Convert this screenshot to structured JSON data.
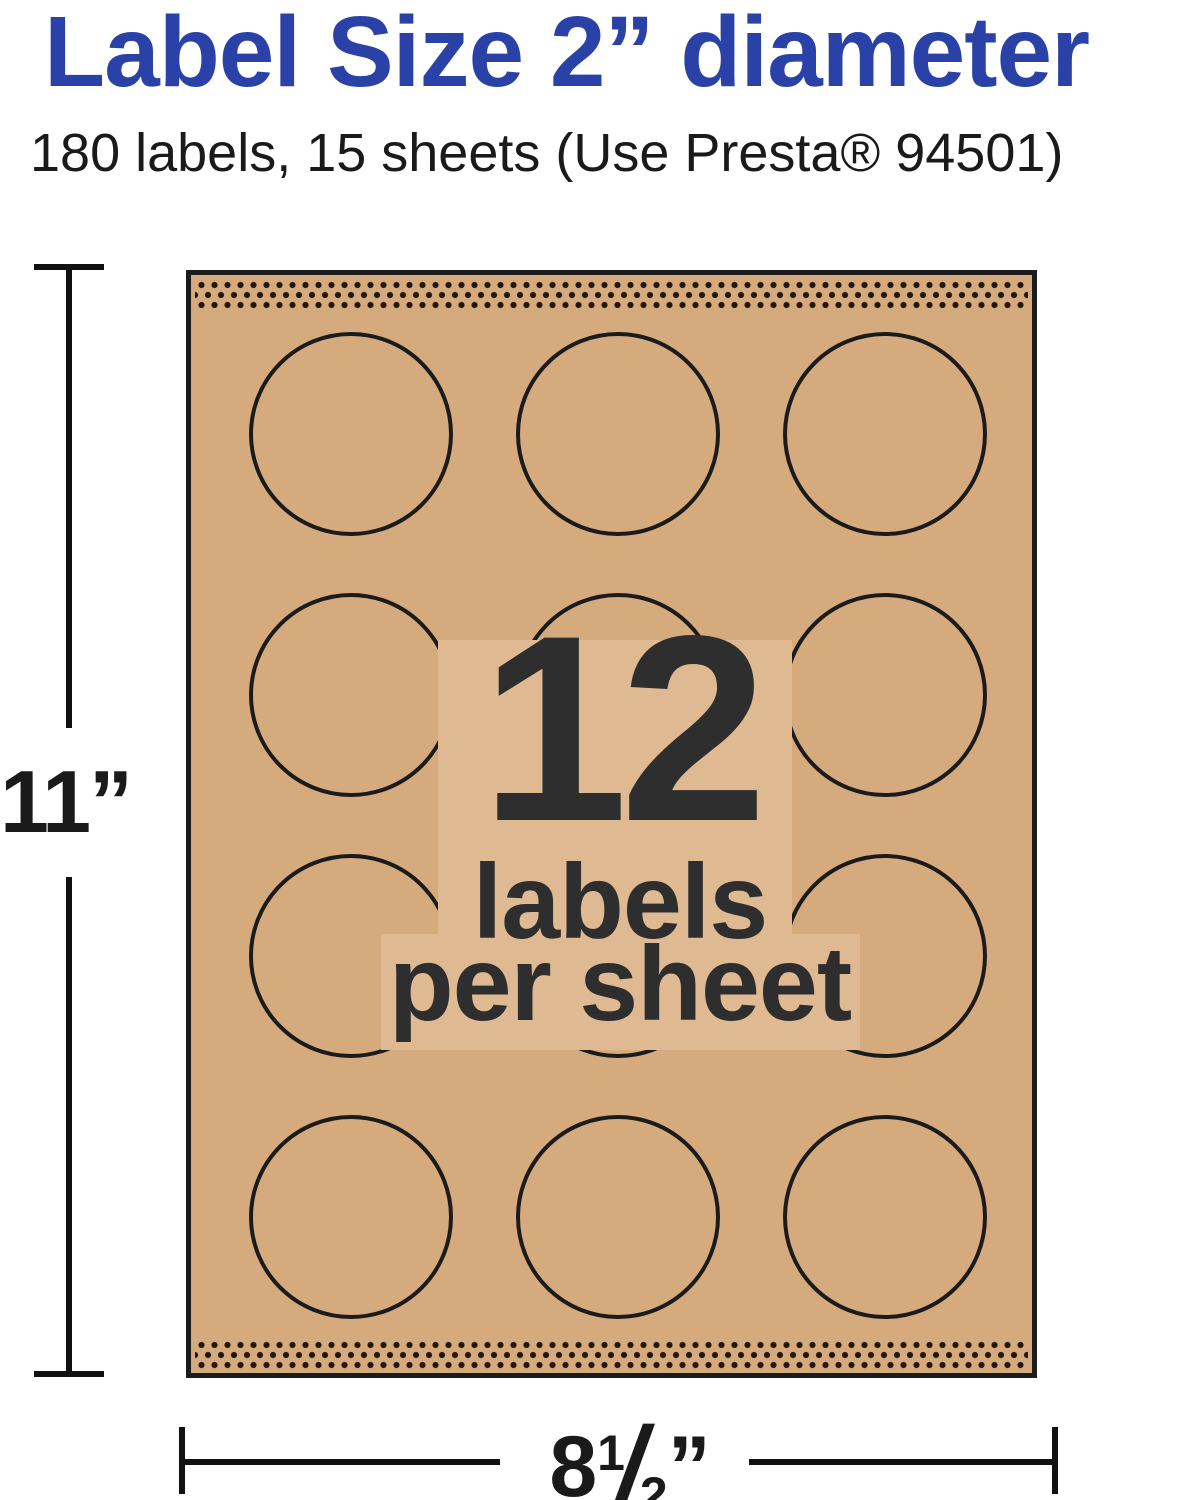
{
  "header": {
    "title": "Label Size 2” diameter",
    "subtitle": "180 labels, 15 sheets (Use Presta® 94501)"
  },
  "sheet": {
    "count": "12",
    "count_caption_line1": "labels",
    "count_caption_line2": "per sheet",
    "grid": {
      "cols": 3,
      "rows": 4
    }
  },
  "dimensions": {
    "height_label": "11”",
    "width_whole": "8",
    "width_fraction_numerator": "1",
    "width_fraction_slash": "/",
    "width_fraction_denominator": "2",
    "width_unit": "”"
  },
  "colors": {
    "accent_blue": "#2A42A8",
    "sheet_tan": "#D5AB7E",
    "backdrop_tan_light": "#DEB992",
    "ink": "#1a1a1a",
    "perforation_dot": "#231507",
    "center_text": "#2E2E2E"
  }
}
